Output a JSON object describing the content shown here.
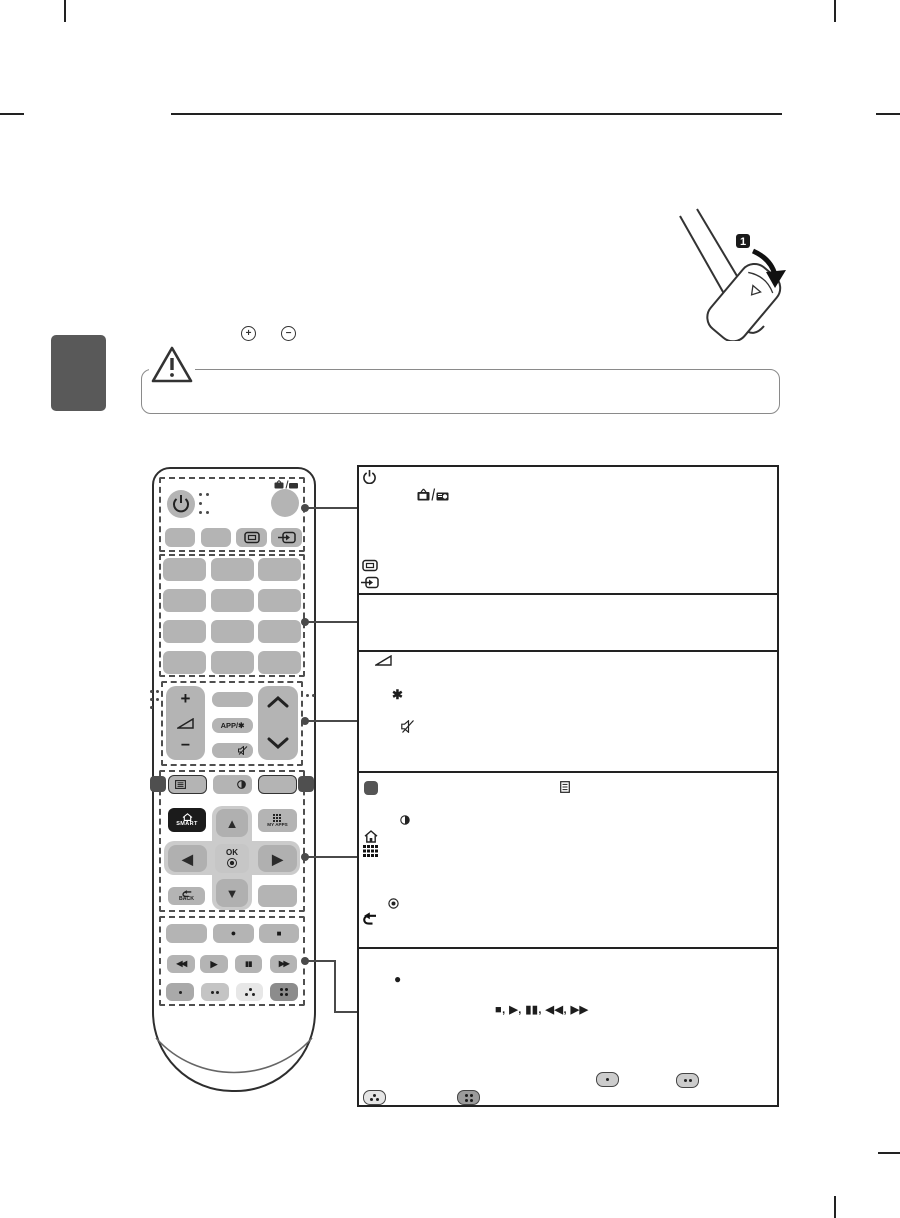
{
  "page": {
    "type": "tv-manual-remote-overview",
    "background": "#ffffff",
    "tab_color": "#595959",
    "rule_color": "#222222",
    "callout_color": "#4a4a4a"
  },
  "battery_note": {
    "plus_symbol": "+",
    "minus_symbol": "−"
  },
  "battery_illustration": {
    "step_badge": "1"
  },
  "caution": {
    "icon": "warning-triangle"
  },
  "remote": {
    "buttons": {
      "app_label": "APP/✱",
      "smart_label": "SMART",
      "my_apps_label": "MY APPS",
      "ok_label": "OK",
      "back_label": "BACK",
      "volume_plus": "+",
      "volume_minus": "−",
      "up": "▲",
      "down": "▼",
      "left": "◀",
      "right": "▶",
      "rewind": "◀◀",
      "play": "▶",
      "pause": "▮▮",
      "forward": "▶▶",
      "record": "●",
      "stop": "■"
    },
    "icons": [
      "power-icon",
      "tv-rad-icon",
      "ratio-icon",
      "input-icon",
      "volume-icon",
      "mute-icon",
      "settings-icon",
      "qmenu-icon",
      "home-icon",
      "apps-grid-icon",
      "back-icon",
      "channel-up-icon",
      "channel-down-icon",
      "color-dot-buttons"
    ]
  },
  "description_table": {
    "row1_icons": [
      "power-icon",
      "tv-rad-icon",
      "ratio-icon",
      "input-icon"
    ],
    "row2_icons": [],
    "row3_icons": [
      "volume-icon",
      "asterisk",
      "mute-icon"
    ],
    "row3_asterisk": "✱",
    "row4_icons": [
      "button-swatch",
      "list-icon",
      "qmenu-icon",
      "home-icon",
      "apps-grid-icon",
      "ok-icon",
      "back-icon"
    ],
    "row5_record": "●",
    "row5_media_sequence": "■, ▶, ▮▮, ◀◀, ▶▶",
    "row5_pill_icons": [
      "one-dot-pill",
      "two-dot-pill",
      "three-dot-pill",
      "four-dot-pill"
    ]
  }
}
